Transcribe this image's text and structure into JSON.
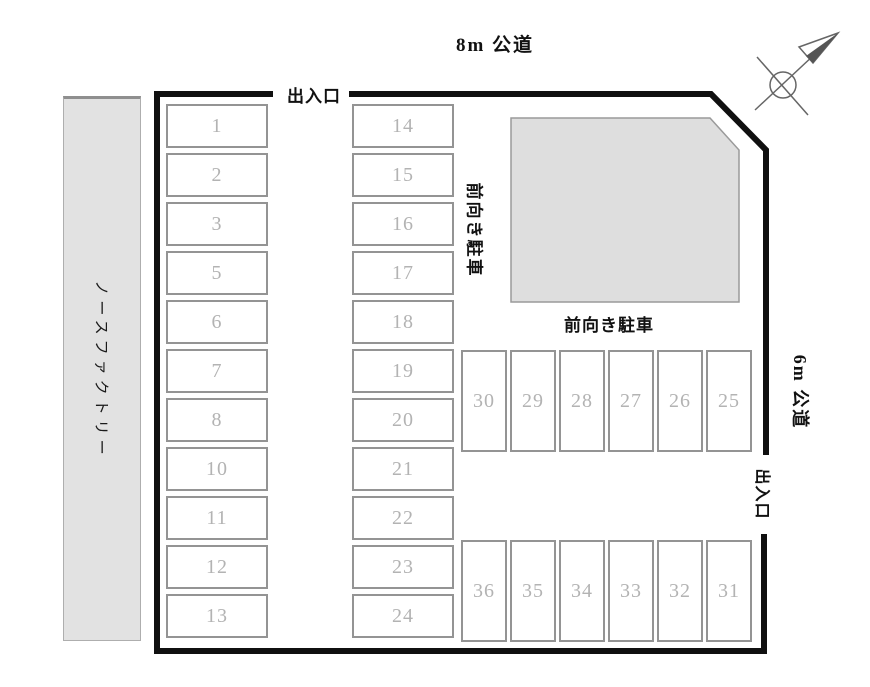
{
  "roads": {
    "top": "8m 公道",
    "right": "6m 公道"
  },
  "entrances": {
    "top": "出入口",
    "right": "出入口"
  },
  "buildings": {
    "left": {
      "label": "ノースファクトリー"
    },
    "upper_right": {
      "label_below": "前向き駐車"
    }
  },
  "notes": {
    "front_facing_parking_vertical": "前向き駐車",
    "front_facing_parking_horizontal": "前向き駐車"
  },
  "parking": {
    "left_column": [
      "1",
      "2",
      "3",
      "5",
      "6",
      "7",
      "8",
      "10",
      "11",
      "12",
      "13"
    ],
    "middle_column": [
      "14",
      "15",
      "16",
      "17",
      "18",
      "19",
      "20",
      "21",
      "22",
      "23",
      "24"
    ],
    "upper_right_row": [
      "30",
      "29",
      "28",
      "27",
      "26",
      "25"
    ],
    "lower_right_row": [
      "36",
      "35",
      "34",
      "33",
      "32",
      "31"
    ]
  },
  "compass": {
    "direction": "north-east-arrow"
  },
  "colors": {
    "boundary": "#101010",
    "stall_border": "#949494",
    "stall_number": "#b3b3b3",
    "building_fill": "#dedede",
    "building_left_fill": "#e2e2e2"
  }
}
